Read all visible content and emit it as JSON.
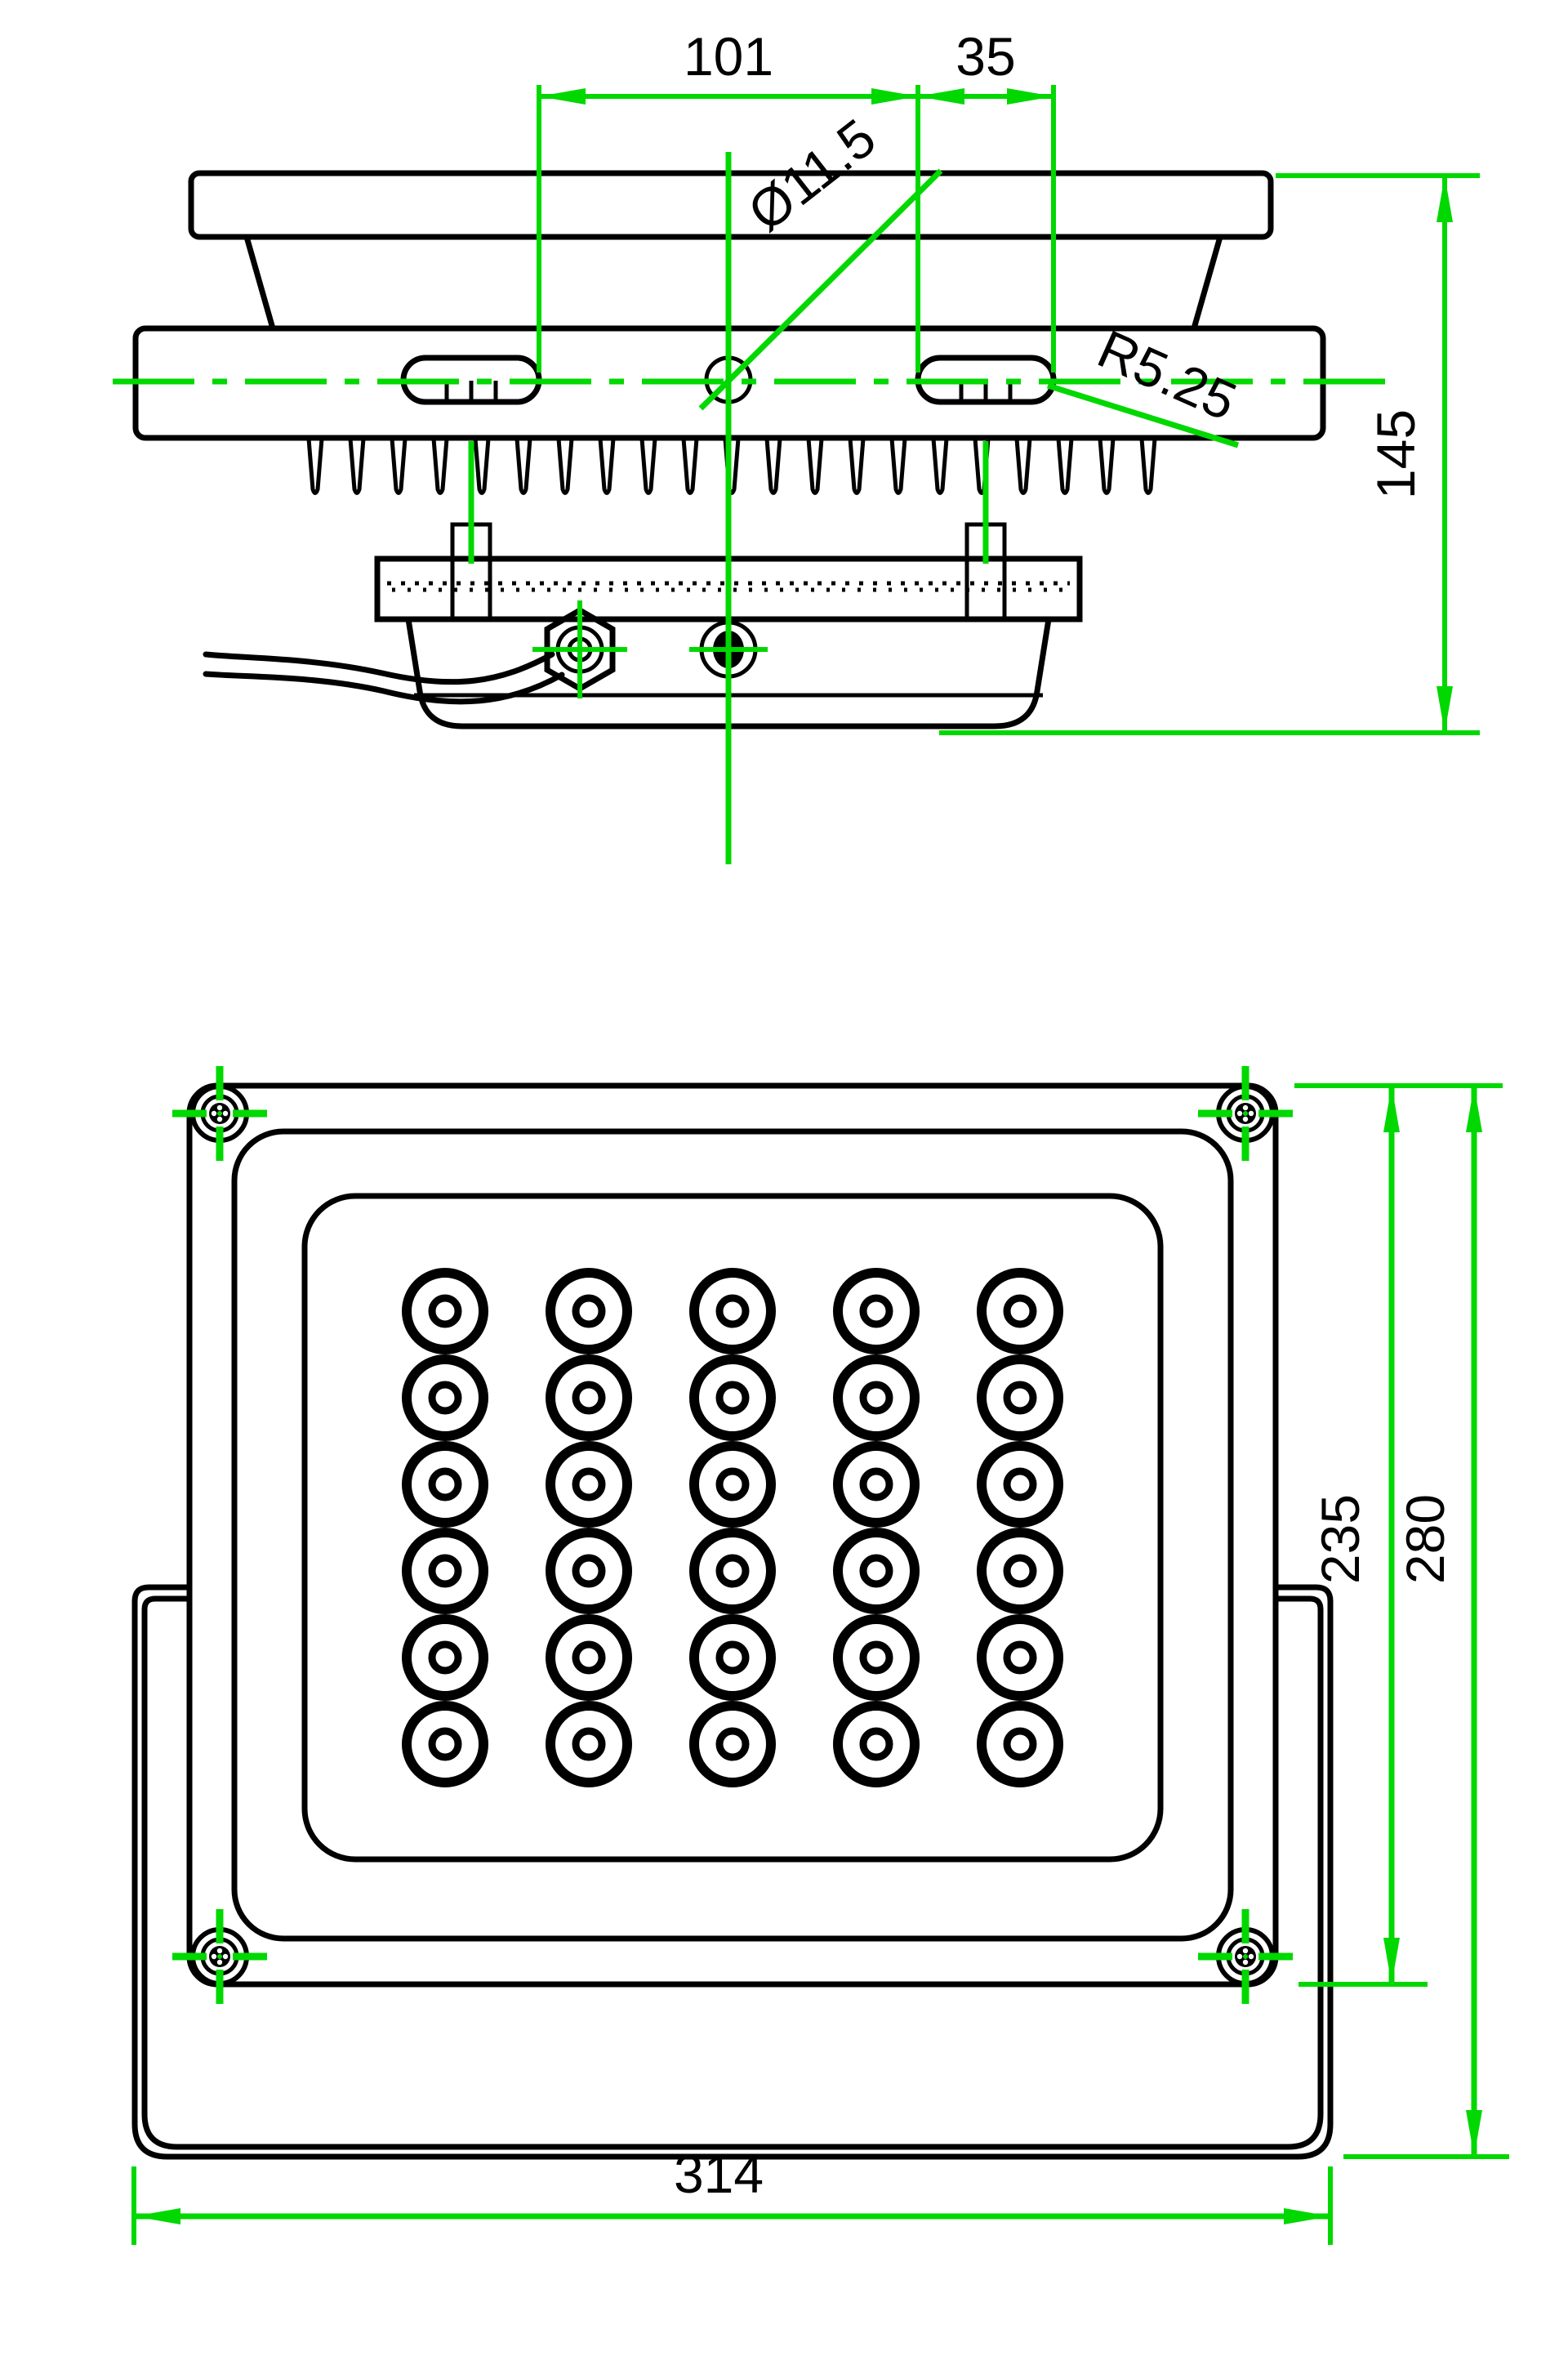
{
  "drawing_title": "LED floodlight dimensional drawing",
  "colors": {
    "background": "#ffffff",
    "outline": "#000000",
    "dimension": "#00d800",
    "text": "#000000"
  },
  "side_view": {
    "dim_center_to_slot": "101",
    "dim_slot_width": "35",
    "dim_hole_diameter": "Ø11.5",
    "dim_slot_radius": "R5.25",
    "dim_overall_height": "145"
  },
  "front_view": {
    "led_grid": {
      "rows": 6,
      "columns": 5,
      "led_count": 30
    },
    "dim_body_height": "235",
    "dim_overall_height": "280",
    "dim_overall_width": "314"
  }
}
